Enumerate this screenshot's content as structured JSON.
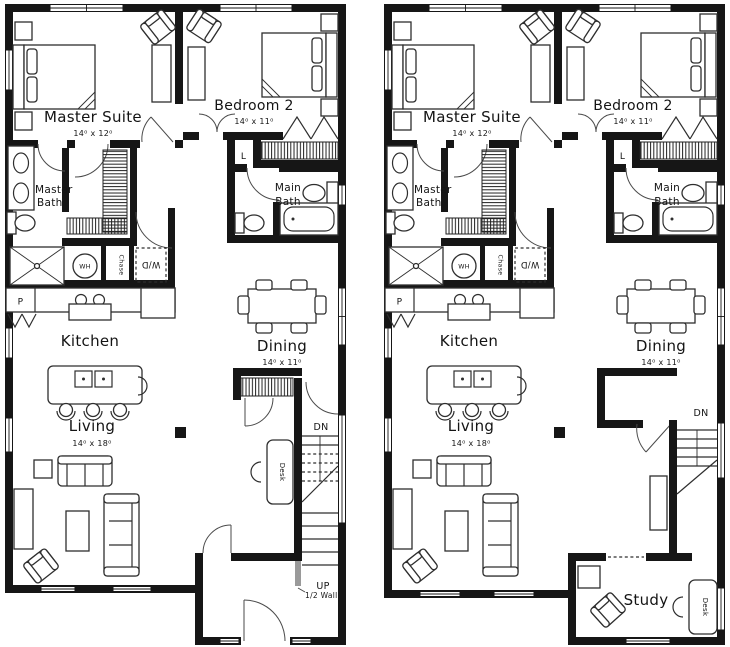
{
  "colors": {
    "ink": "#161616",
    "paper": "#ffffff",
    "half_wall_gray": "#9a9a9a"
  },
  "labels": {
    "master_suite": "Master Suite",
    "master_suite_dims": "14⁰ x 12⁰",
    "bedroom2": "Bedroom 2",
    "bedroom2_dims": "14⁰ x 11⁰",
    "master_bath_1": "Master",
    "master_bath_2": "Bath",
    "main_bath_1": "Main",
    "main_bath_2": "Bath",
    "linen": "L",
    "washer_dryer": "W/D",
    "water_heater": "WH",
    "chase": "Chase",
    "pantry": "P",
    "kitchen": "Kitchen",
    "dining": "Dining",
    "dining_dims": "14⁰ x 11⁰",
    "living": "Living",
    "living_dims": "14⁰ x 18⁰",
    "desk": "Desk",
    "down": "DN",
    "up": "UP",
    "half_wall": "1/2 Wall",
    "study": "Study"
  }
}
